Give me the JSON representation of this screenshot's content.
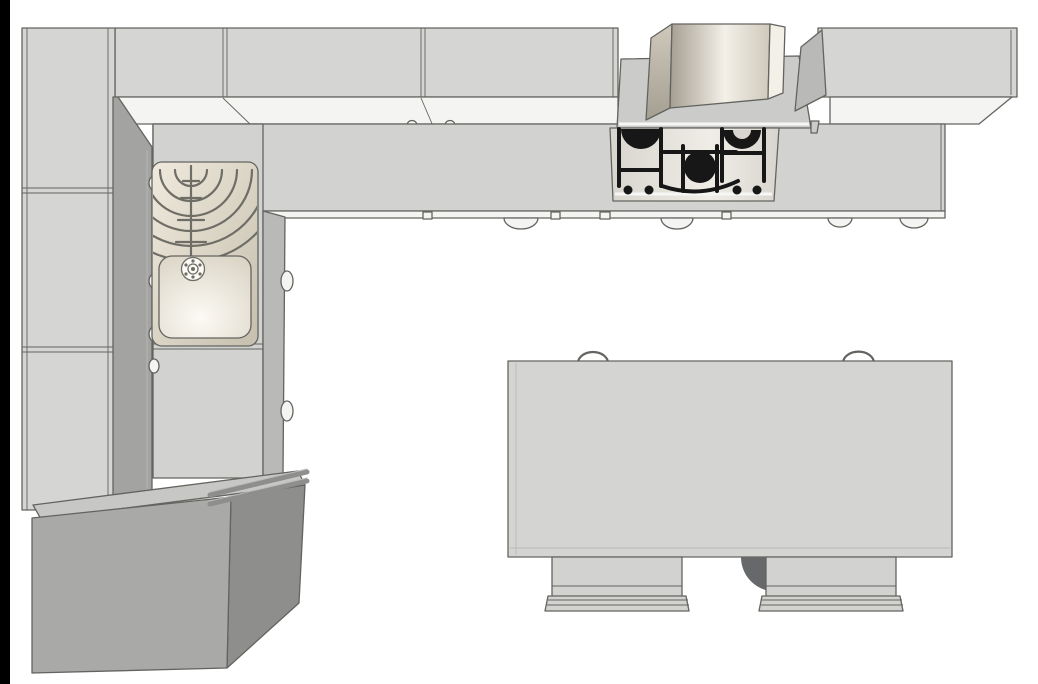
{
  "meta": {
    "title": "Top-down 3D render of an L-shaped kitchen with island table"
  },
  "scene": {
    "background": "#ffffff",
    "colors": {
      "frame": "#000000",
      "outline": "#63645f",
      "line_soft": "#b9b9b6",
      "white_edge": "#f6f6f5",
      "cabinet_top": "#d5d6d4",
      "cabinet_front": "#f4f4f2",
      "counter": "#d2d3d1",
      "side_dark": "#a3a4a2",
      "side_mid": "#b9bab8",
      "block_top": "#c7c8c6",
      "block_front": "#a9aaa8",
      "block_side": "#8e8f8d",
      "table_top": "#d4d5d3",
      "chair_body": "#d2d3d1",
      "chair_dark": "#66686a",
      "hood_plate": "#cbccca",
      "steel_dark": "#a59f92",
      "steel_mid": "#cfc9bc",
      "steel_light": "#f3f0e8",
      "panel_mid": "#d8d5ce",
      "panel_light": "#efede6",
      "sink_rim_light": "#efeadd",
      "sink_rim_dark": "#c6bfae",
      "sink_light": "#fcfaf4",
      "sink_warm": "#d8d2c3",
      "sink_line": "#6e6d66",
      "grate": "#171717"
    },
    "objects": {
      "tall_cabinets": {
        "label": "tall-cabinet-run-left-wall",
        "sections": 3,
        "knobs": 4
      },
      "wall_cabinets": {
        "label": "wall-cabinet-run-top-wall",
        "sections_left": 3,
        "sections_right": 1
      },
      "countertop": {
        "label": "l-shaped-countertop",
        "drawer_handles": 4,
        "small_tabs": 4,
        "run_knobs": 2
      },
      "sink": {
        "label": "sink-with-drainboard",
        "drainer_ridges": 6,
        "drain_holes": 6
      },
      "cooktop": {
        "label": "gas-cooktop",
        "visible_burners": 3,
        "control_knobs": 4
      },
      "hood": {
        "label": "chimney-range-hood"
      },
      "base_block": {
        "label": "base-cabinet-unit-bottom-left",
        "handle_bars": 2
      },
      "island": {
        "label": "island-table",
        "chairs": 2,
        "chair_back_loops": 2
      }
    }
  }
}
